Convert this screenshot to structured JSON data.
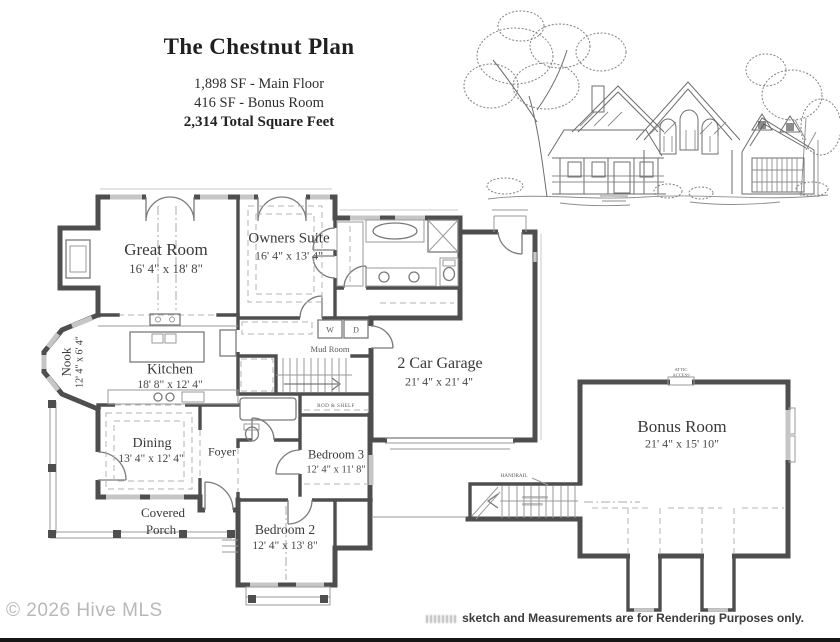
{
  "header": {
    "title": "The Chestnut Plan",
    "area_lines": [
      "1,898 SF - Main Floor",
      "416 SF - Bonus Room",
      "2,314 Total Square Feet"
    ]
  },
  "rooms": {
    "great_room": {
      "name": "Great Room",
      "dims": "16' 4\" x 18' 8\""
    },
    "owners_suite": {
      "name": "Owners Suite",
      "dims": "16' 4\" x 13' 4\""
    },
    "nook": {
      "name": "Nook",
      "dims": "12' 4\" x 6' 4\""
    },
    "kitchen": {
      "name": "Kitchen",
      "dims": "18' 8\" x 12' 4\""
    },
    "mud_room": {
      "name": "Mud Room"
    },
    "garage": {
      "name": "2 Car Garage",
      "dims": "21' 4\" x 21' 4\""
    },
    "dining": {
      "name": "Dining",
      "dims": "13' 4\" x 12' 4\""
    },
    "foyer": {
      "name": "Foyer"
    },
    "bedroom_3": {
      "name": "Bedroom 3",
      "dims": "12' 4\" x 11' 8\""
    },
    "bedroom_2": {
      "name": "Bedroom 2",
      "dims": "12' 4\" x 13' 8\""
    },
    "covered_porch": {
      "line1": "Covered",
      "line2": "Porch"
    },
    "bonus_room": {
      "name": "Bonus Room",
      "dims": "21' 4\" x 15' 10\""
    }
  },
  "annotations": {
    "washer": "W",
    "dryer": "D",
    "rod_shelf": "ROD & SHELF",
    "handrail": "HANDRAIL",
    "attic_1": "ATTIC",
    "attic_2": "ACCESS"
  },
  "footer": {
    "copyright": "© 2026 Hive MLS",
    "disclaimer": "sketch and Measurements are for Rendering Purposes only."
  },
  "colors": {
    "wall": "#4e4e4e",
    "text": "#3a3a3a",
    "watermark": "#b8b8b8"
  }
}
